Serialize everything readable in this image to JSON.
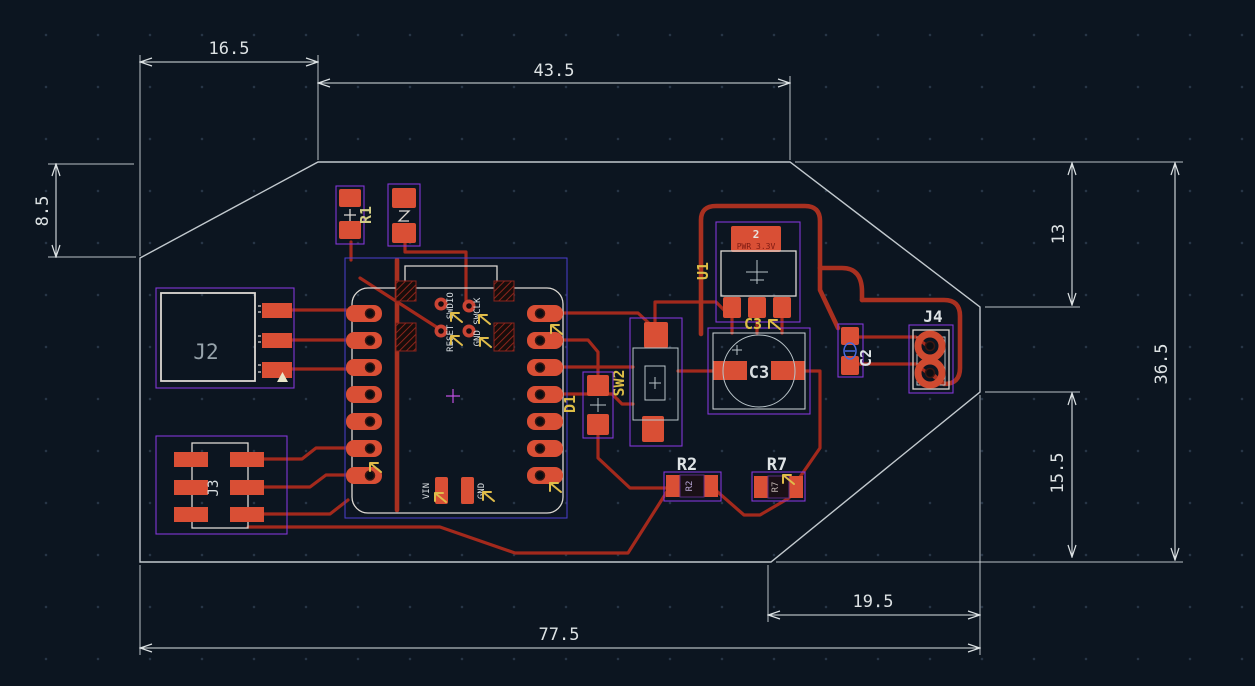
{
  "view": {
    "type": "pcb-layout-canvas",
    "units": "mm",
    "colors": {
      "background": "#0c1520",
      "copper": "#a93020",
      "pad": "#d94f35",
      "silkscreen": "#dcd8d2",
      "courtyard": "#8237d6",
      "board_outline": "#c2c9ce",
      "dimension": "#dde2e4",
      "highlight_yellow": "#ddbe46"
    }
  },
  "dims": {
    "d165": "16.5",
    "d435": "43.5",
    "d85": "8.5",
    "d13": "13",
    "d365": "36.5",
    "d155": "15.5",
    "d195": "19.5",
    "d775": "77.5"
  },
  "refs": {
    "r1": "R1",
    "j2": "J2",
    "j3": "J3",
    "u1": "U1",
    "c3": "C3",
    "c2": "C2",
    "j4": "J4",
    "sw2": "SW2",
    "d1": "D1",
    "r2": "R2",
    "r7": "R7"
  },
  "silk": {
    "c3": "C3",
    "r2": "R2",
    "r7": "R7",
    "u1_pad_number": "2",
    "u1_pad_net": "PWR_3.3V",
    "module_reset": "RESET SWDIO",
    "module_swclk": "GND SWCLK",
    "module_vin": "VIN",
    "module_gnd": "GND"
  }
}
